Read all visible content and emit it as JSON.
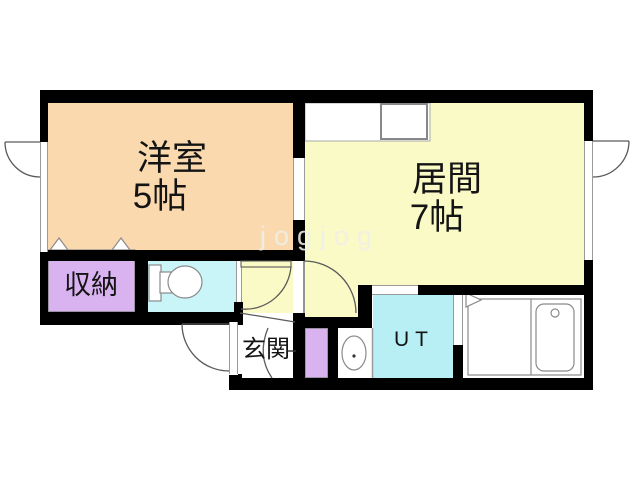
{
  "watermark": "jogjog",
  "rooms": {
    "bedroom": {
      "label": "洋室",
      "size": "5帖",
      "color": "#FBD9AE"
    },
    "living": {
      "label": "居間",
      "size": "7帖",
      "color": "#FAFAC6"
    },
    "storage": {
      "label": "収納",
      "color": "#D9B2F0"
    },
    "entrance": {
      "label": "玄関",
      "color": "#FFFFFF"
    },
    "utility": {
      "label": "UT",
      "color": "#B8EFF4"
    },
    "toilet": {
      "color": "#C9F4F8"
    }
  },
  "colors": {
    "wall": "#000000",
    "fixture_stroke": "#808080",
    "door_stroke": "#5A5A5A",
    "watermark_text": "#EFEFE8"
  }
}
